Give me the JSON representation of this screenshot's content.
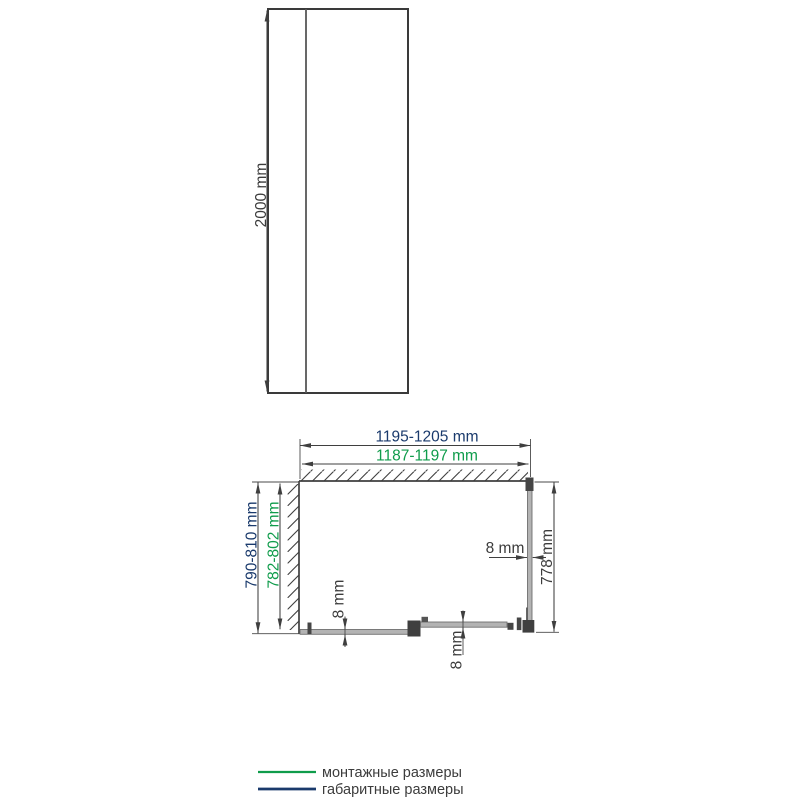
{
  "front_view": {
    "height": "2000 mm"
  },
  "plan_view": {
    "overall_width": "1195-1205 mm",
    "mounting_width": "1187-1197 mm",
    "overall_depth": "790-810 mm",
    "mounting_depth": "782-802 mm",
    "side_panel_length": "778 mm",
    "glass_thickness_fixed": "8 mm",
    "glass_thickness_door": "8 mm",
    "glass_thickness_side": "8 mm"
  },
  "legend": {
    "items": [
      {
        "label": "монтажные размеры",
        "color": "#0F9C4B"
      },
      {
        "label": "габаритные размеры",
        "color": "#1A3A6C"
      }
    ]
  },
  "colors": {
    "navy": "#1A3A6C",
    "green": "#0F9C4B",
    "line": "#3F3F3F",
    "glass": "#B3B3B3",
    "profile": "#454545",
    "text": "#3C3C3C"
  }
}
